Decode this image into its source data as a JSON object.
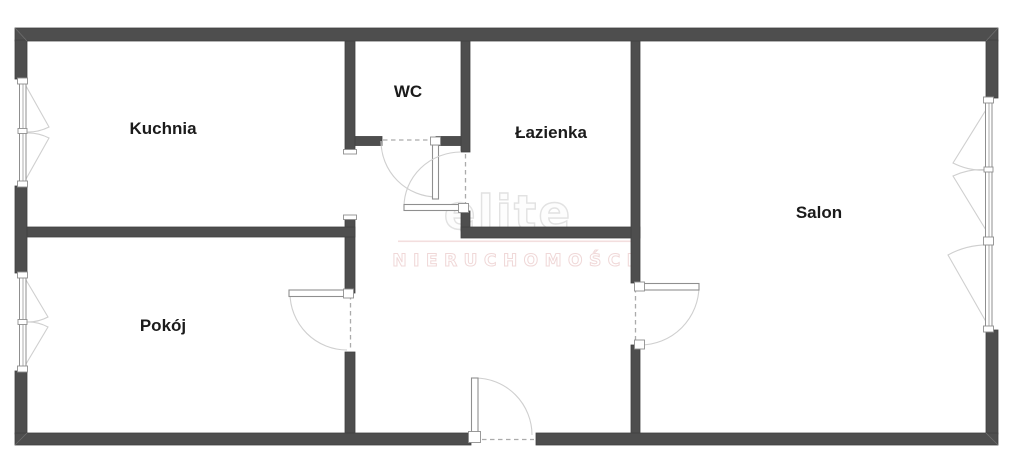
{
  "floorplan": {
    "rooms": [
      {
        "id": "kuchnia",
        "label": "Kuchnia"
      },
      {
        "id": "wc",
        "label": "WC"
      },
      {
        "id": "lazienka",
        "label": "Łazienka"
      },
      {
        "id": "salon",
        "label": "Salon"
      },
      {
        "id": "pokoj",
        "label": "Pokój"
      }
    ],
    "watermark": {
      "brand": "elite",
      "subtitle": "NIERUCHOMOŚCI"
    },
    "colors": {
      "wall": "#4e4e4e",
      "room_label": "#1b1b1b",
      "door_window_frame": "#8f8f8f",
      "swing_arc": "#cfcfcf",
      "opening_dash": "#ababab",
      "watermark_brand_outline": "#e2e2e2",
      "watermark_subtitle_outline": "#f0d8d8",
      "background": "#ffffff"
    }
  }
}
